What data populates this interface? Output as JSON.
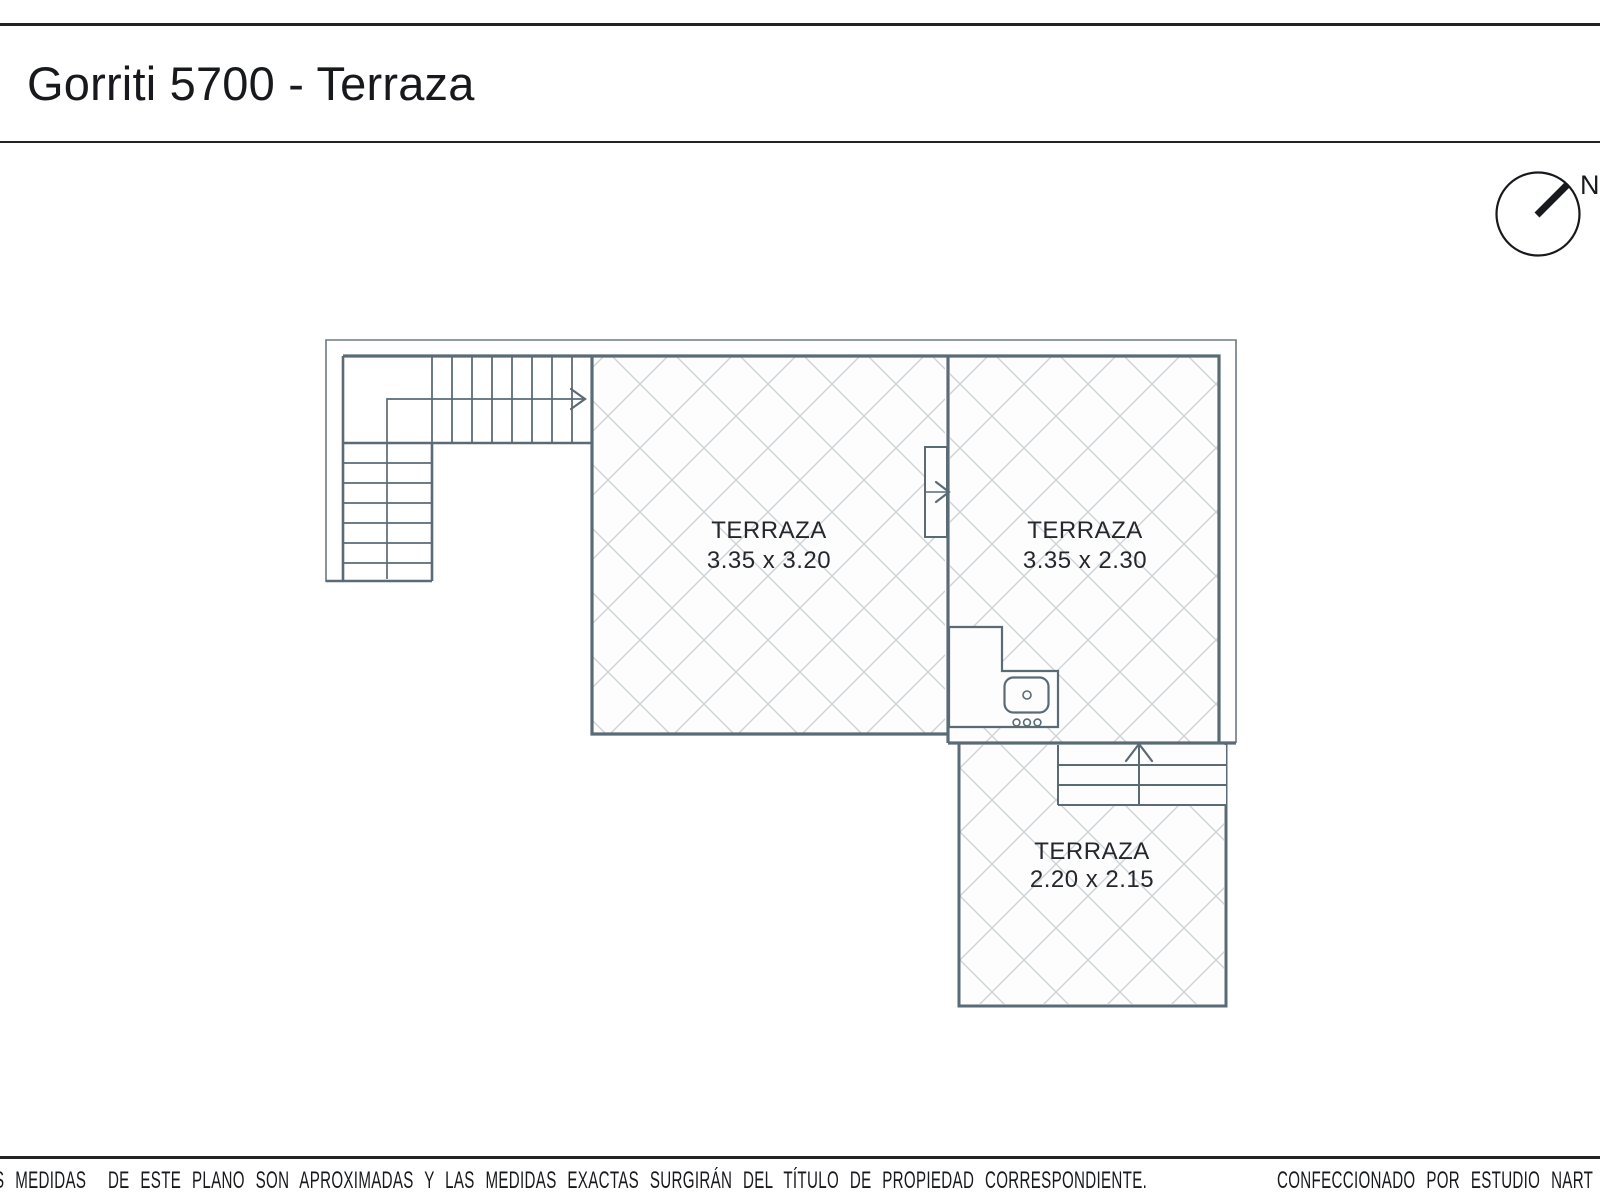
{
  "title": {
    "text": "Gorriti 5700 - Terraza"
  },
  "compass": {
    "label": "N"
  },
  "rooms": [
    {
      "name": "TERRAZA",
      "dimensions": "3.35 x 3.20"
    },
    {
      "name": "TERRAZA",
      "dimensions": "3.35 x 2.30"
    },
    {
      "name": "TERRAZA",
      "dimensions": "2.20 x 2.15"
    }
  ],
  "footer": {
    "disclaimer": "S MEDIDAS  DE ESTE PLANO SON APROXIMADAS Y LAS MEDIDAS EXACTAS SURGIRÁN DEL TÍTULO DE PROPIEDAD CORRESPONDIENTE.",
    "credit": "CONFECCIONADO POR ESTUDIO NART"
  },
  "colors": {
    "wall": "#5b6b76",
    "outline": "#6b7a84",
    "hatch": "#ced3d6",
    "ink": "#17191c",
    "rule": "#232323",
    "paper": "#ffffff"
  }
}
